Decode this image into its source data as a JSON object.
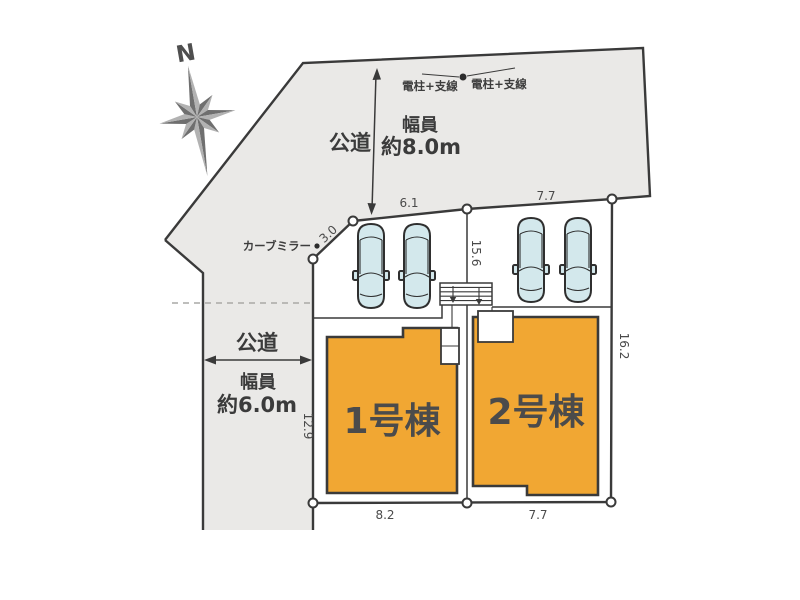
{
  "title": "site-plan",
  "compass": {
    "north_label": "N"
  },
  "road_top": {
    "label": "公道",
    "width_caption": "幅員",
    "width_value": "約8.0m"
  },
  "road_left": {
    "label": "公道",
    "width_caption": "幅員",
    "width_value": "約6.0m"
  },
  "utility_poles": {
    "left_label": "電柱+支線",
    "right_label": "電柱+支線"
  },
  "curve_mirror_label": "カーブミラー",
  "buildings": [
    {
      "label": "1号棟"
    },
    {
      "label": "2号棟"
    }
  ],
  "measurements": {
    "lot1_frontage_top": "6.1",
    "lot2_frontage_top": "7.7",
    "lot1_frontage_bottom": "8.2",
    "lot2_frontage_bottom": "7.7",
    "lot1_west_side": "12.9",
    "lot2_east_side": "16.2",
    "center_boundary": "15.6",
    "splay_corner": "3.0"
  },
  "colors": {
    "road": "#eae9e7",
    "building": "#f1a733",
    "outline": "#3a3a3a",
    "car": "#d3e8ec",
    "text": "#454545"
  }
}
